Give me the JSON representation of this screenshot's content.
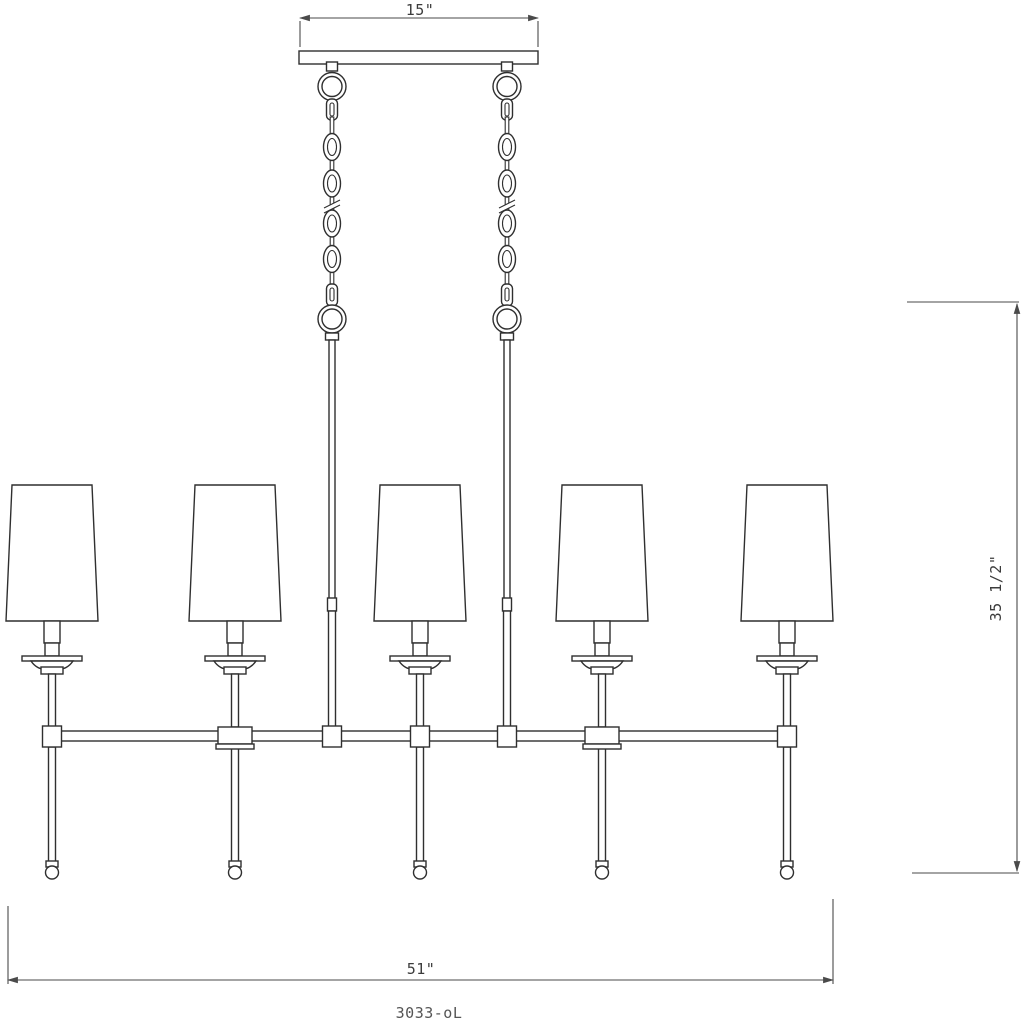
{
  "drawing": {
    "type": "product-dimension-diagram",
    "subject": "5-light linear chandelier with two hanging chains",
    "dimensions": {
      "canopy_width": "15\"",
      "overall_width": "51\"",
      "overall_height": "35 1/2\""
    },
    "model_label": "3033-oL",
    "colors": {
      "line": "#2f2f2f",
      "dimension_line": "#4a4a4a",
      "background": "#ffffff",
      "shade_fill": "#ffffff"
    }
  }
}
